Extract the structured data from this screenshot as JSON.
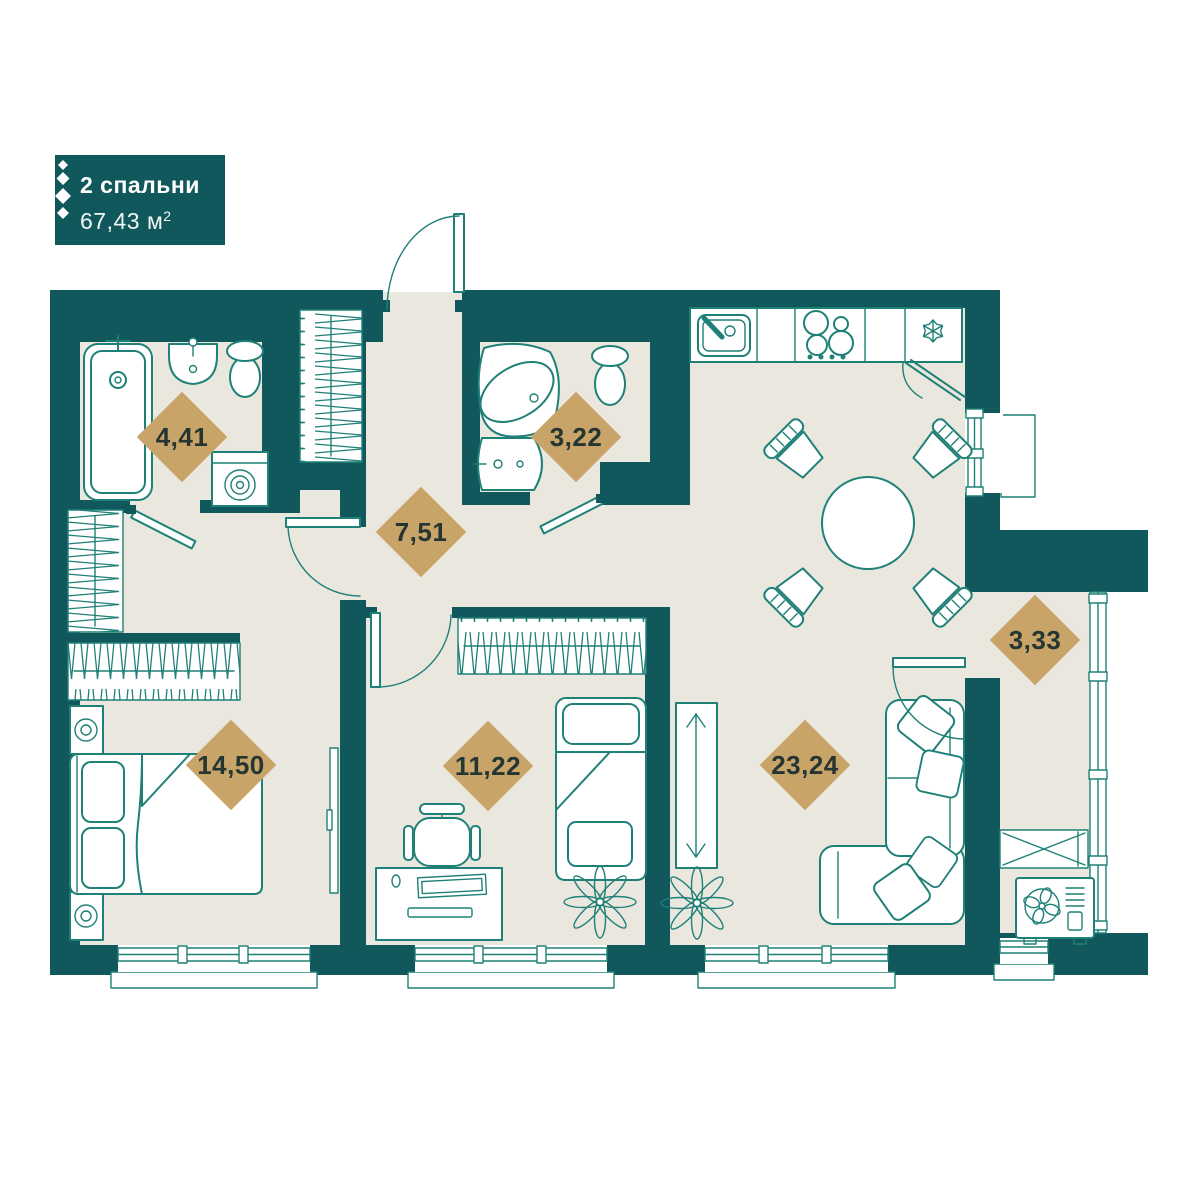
{
  "header": {
    "bedrooms_label": "2 спальни",
    "area_value": "67,43 м",
    "area_superscript": "2"
  },
  "rooms": [
    {
      "area": "4,41"
    },
    {
      "area": "3,22"
    },
    {
      "area": "7,51"
    },
    {
      "area": "14,50"
    },
    {
      "area": "11,22"
    },
    {
      "area": "23,24"
    },
    {
      "area": "3,33"
    }
  ],
  "colors": {
    "wall": "#11585c",
    "floor": "#eae7df",
    "outline": "#1f8077",
    "area_badge": "#c9a469",
    "area_badge_text": "#253531",
    "header_text": "#ffffff"
  }
}
